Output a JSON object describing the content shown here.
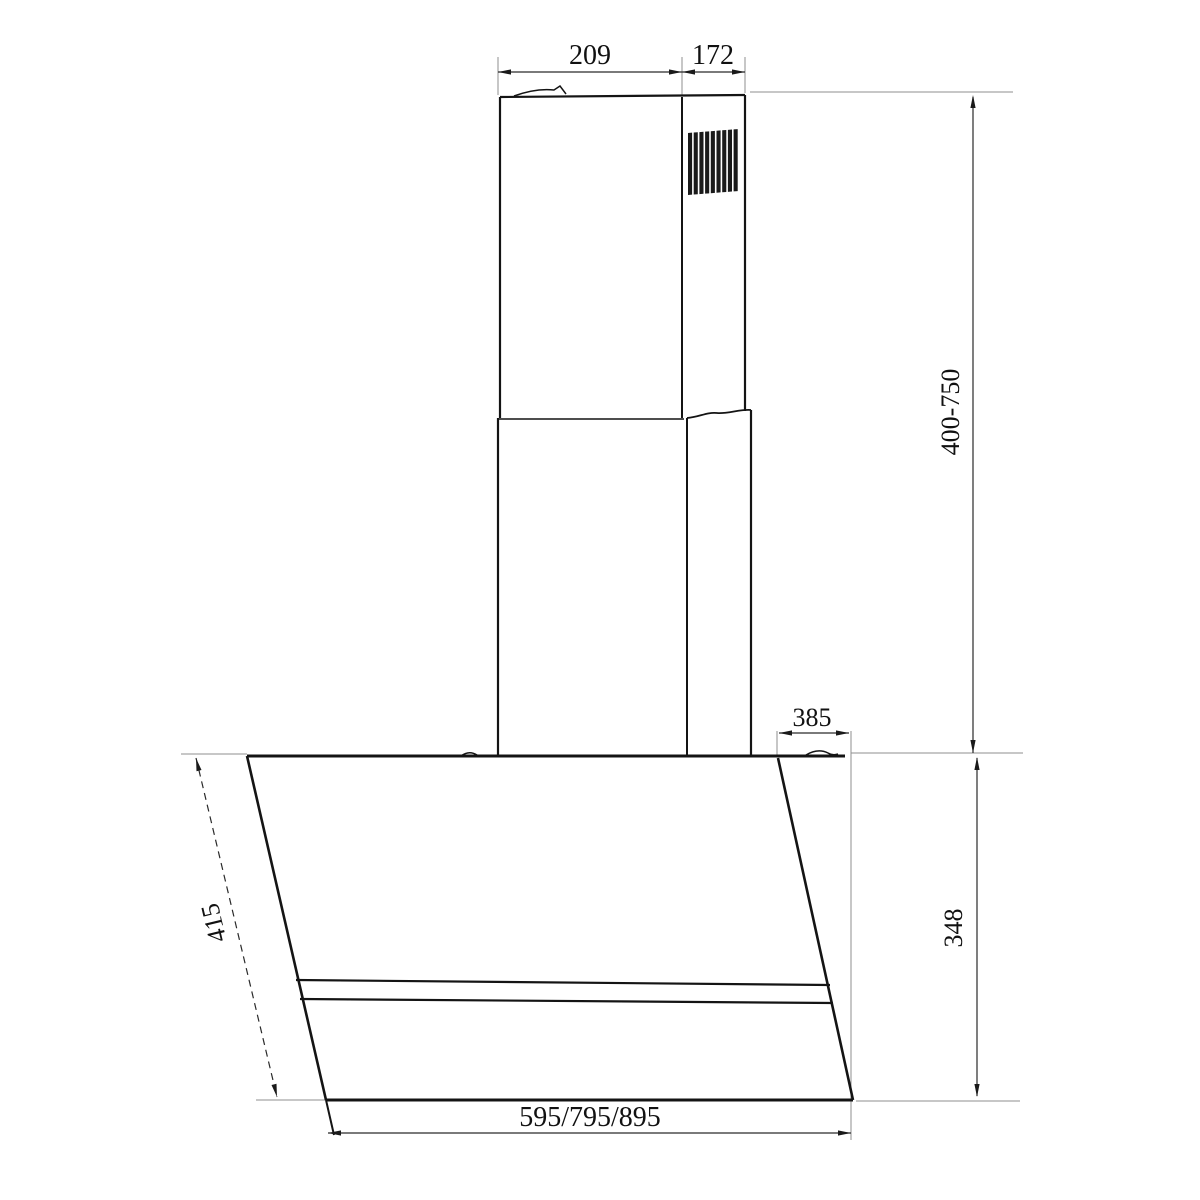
{
  "meta": {
    "type": "technical-dimension-drawing",
    "subject": "wall-mounted angled cooker hood with telescopic chimney"
  },
  "labels": {
    "chimney_front_width": "209",
    "chimney_side_depth": "172",
    "chimney_height_range": "400-750",
    "hood_top_depth": "385",
    "body_height": "348",
    "glass_panel_length": "415",
    "available_widths": "595/795/895"
  },
  "colors": {
    "object_line": "#141414",
    "dimension_line": "#2a2a2a",
    "extension_line": "#8f8f8f",
    "text": "#111111",
    "background": "#ffffff"
  }
}
